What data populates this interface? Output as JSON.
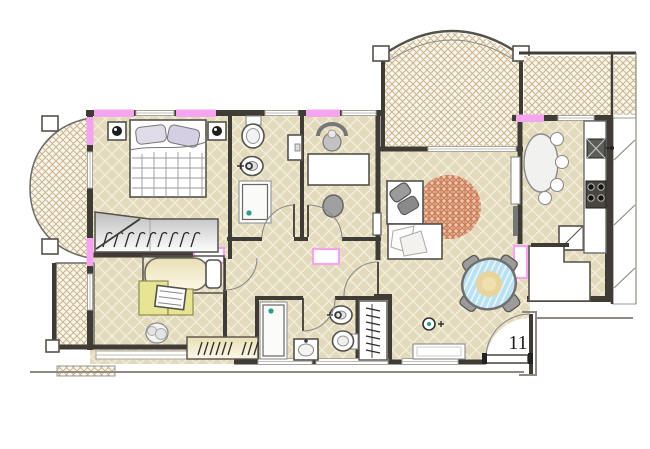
{
  "floor_plan": {
    "unit_label": "11",
    "colors": {
      "wall": "#3f3b35",
      "outline": "#8f8b84",
      "floor": "#e3dabd",
      "floorLine": "#f3eeda",
      "balconyBg": "#faf6ea",
      "balconyLine": "#c8b48e",
      "pink": "#f5a4ef",
      "rugBg": "#eec7ab",
      "rugLine": "#c97d5a",
      "glass": "#b9e1f1",
      "glassLine": "#eaf7fc",
      "glassCenter": "#ead397",
      "yellow": "#e7e494",
      "cream": "#f1e8c5",
      "gray": "#9b9b9b",
      "white": "#ffffff",
      "teal": "#2a9d8f",
      "text": "#1c1c1c"
    },
    "symbols": [
      "double-bed",
      "nightstand-lamp",
      "wardrobe-hangers",
      "single-bed",
      "desk",
      "office-chair",
      "toilet",
      "bidet",
      "shower",
      "washbasin",
      "kitchen-sink",
      "stove-burners",
      "round-kitchen-table",
      "glass-dining-table",
      "dining-chair",
      "daybed",
      "round-rug",
      "tv-cabinet",
      "corner-cabinet",
      "coat-rack",
      "door-swing",
      "window-marker",
      "entrance-door",
      "doormat"
    ]
  }
}
